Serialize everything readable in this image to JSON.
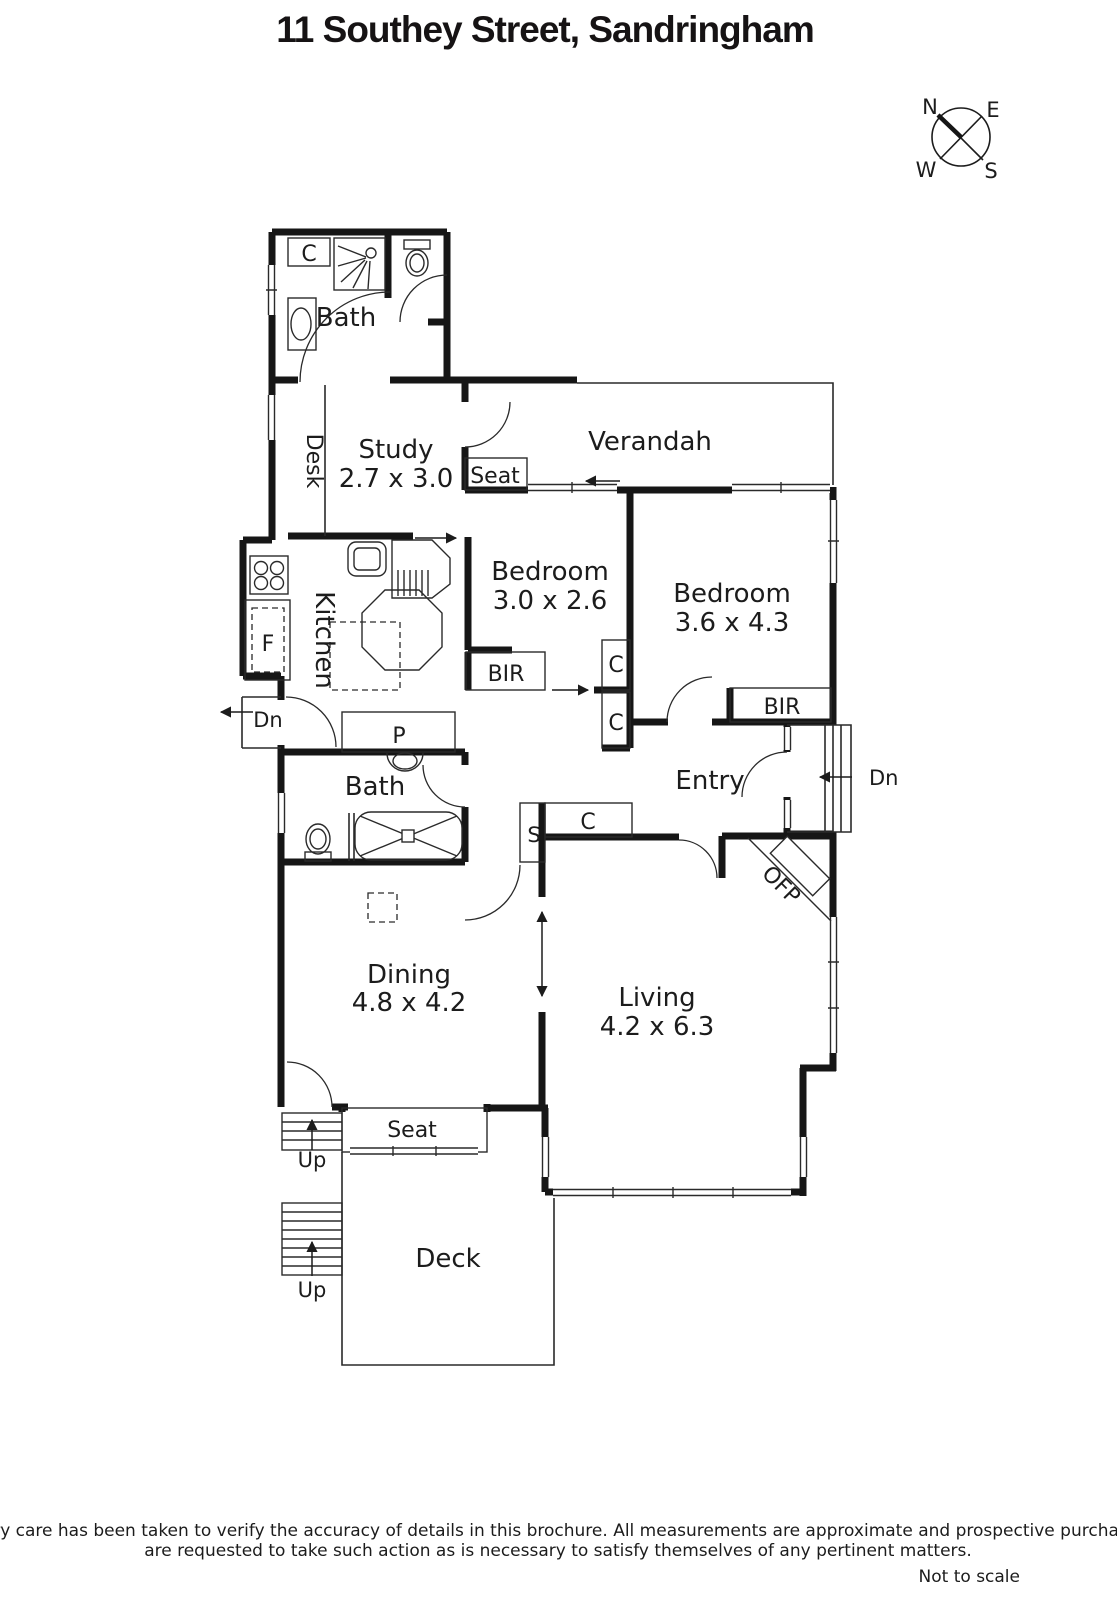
{
  "title": "11 Southey Street, Sandringham",
  "compass": {
    "n": "N",
    "e": "E",
    "w": "W",
    "s": "S"
  },
  "rooms": {
    "bath_top": {
      "name": "Bath"
    },
    "study": {
      "name": "Study",
      "size": "2.7 x 3.0"
    },
    "verandah": {
      "name": "Verandah"
    },
    "bedroom_small": {
      "name": "Bedroom",
      "size": "3.0 x 2.6"
    },
    "bedroom_large": {
      "name": "Bedroom",
      "size": "3.6 x 4.3"
    },
    "kitchen": {
      "name": "Kitchen"
    },
    "bath_middle": {
      "name": "Bath"
    },
    "entry": {
      "name": "Entry"
    },
    "dining": {
      "name": "Dining",
      "size": "4.8 x 4.2"
    },
    "living": {
      "name": "Living",
      "size": "4.2 x 6.3"
    },
    "deck": {
      "name": "Deck"
    }
  },
  "features": {
    "closet": "C",
    "desk": "Desk",
    "seat": "Seat",
    "bir": "BIR",
    "fridge": "F",
    "pantry": "P",
    "store": "S",
    "fireplace": "OFP",
    "down": "Dn",
    "up": "Up"
  },
  "footer": {
    "line1": "Every care has been taken to verify the accuracy of details in this brochure.  All measurements are approximate and prospective purchasers",
    "line2": "are requested to take such action as is necessary to satisfy themselves of any pertinent matters.",
    "scale": "Not to scale"
  }
}
